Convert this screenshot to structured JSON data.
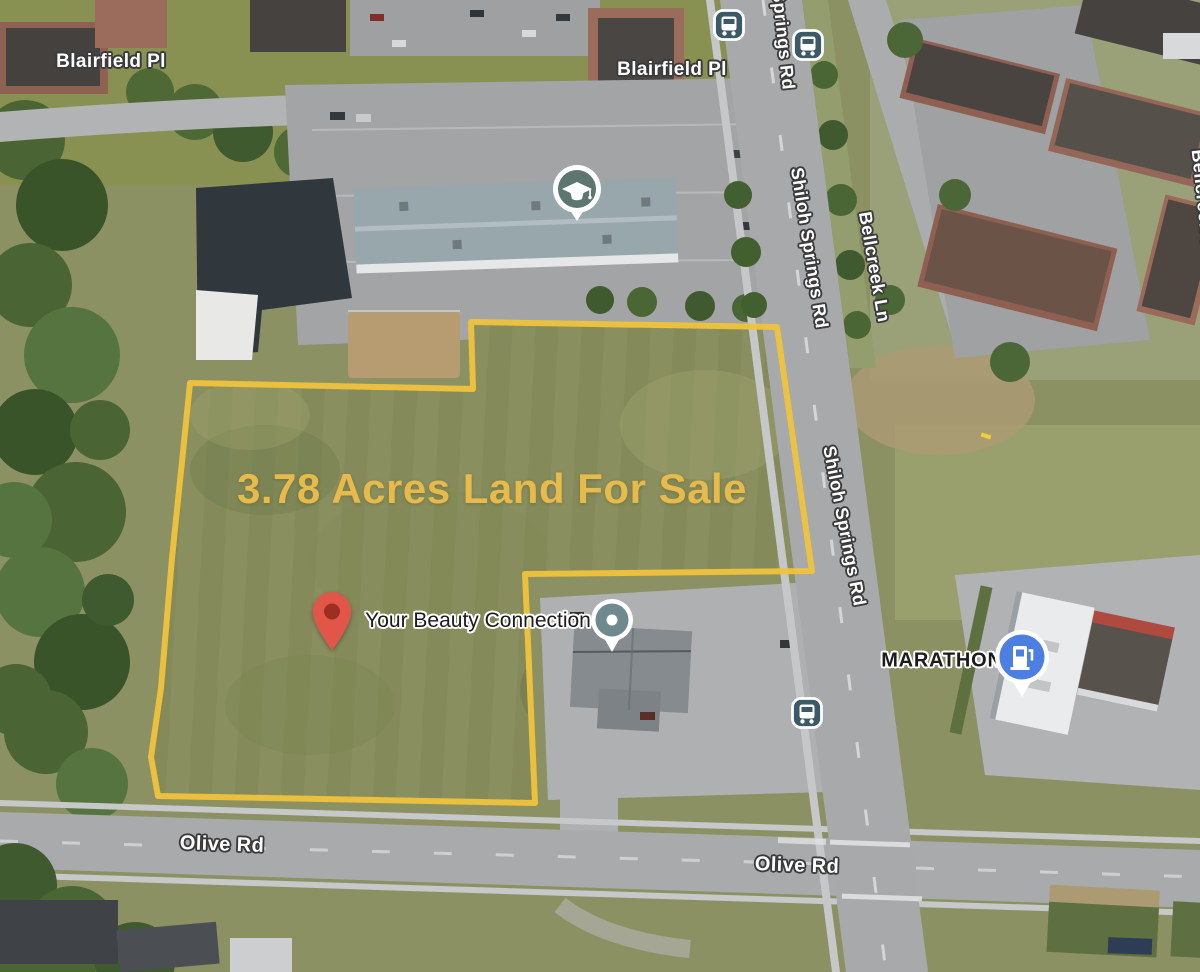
{
  "map": {
    "overlay": {
      "title": "3.78 Acres Land For Sale",
      "title_color": "#E7BB4B",
      "boundary_color": "#EFC33C",
      "boundary_points": "190,383 473,389 471,322 777,327 812,571 525,574 535,803 158,796 151,757 161,688 172,558 183,452"
    },
    "road_labels": [
      {
        "text": "Blairfield Pl"
      },
      {
        "text": "Blairfield Pl"
      },
      {
        "text": "Springs Rd"
      },
      {
        "text": "Shiloh Springs Rd"
      },
      {
        "text": "Bellcreek Ln"
      },
      {
        "text": "Bellcreek Ln"
      },
      {
        "text": "Shiloh Springs Rd"
      },
      {
        "text": "Olive Rd"
      },
      {
        "text": "Olive Rd"
      }
    ],
    "poi_labels": [
      {
        "text": "Your Beauty Connection"
      },
      {
        "text": "MARATHON"
      }
    ],
    "markers": {
      "school": {
        "type": "school-marker",
        "color": "#5D7670"
      },
      "beauty_poi": {
        "type": "poi-circle-marker",
        "color": "#6F8A8F"
      },
      "gas": {
        "type": "gas-station-marker",
        "color": "#4D7FE3"
      },
      "bus": {
        "type": "bus-stop-icon",
        "color": "#3C5A66"
      },
      "pin": {
        "type": "red-map-pin",
        "color": "#E2564A",
        "dot_color": "#9C2E22"
      }
    }
  }
}
